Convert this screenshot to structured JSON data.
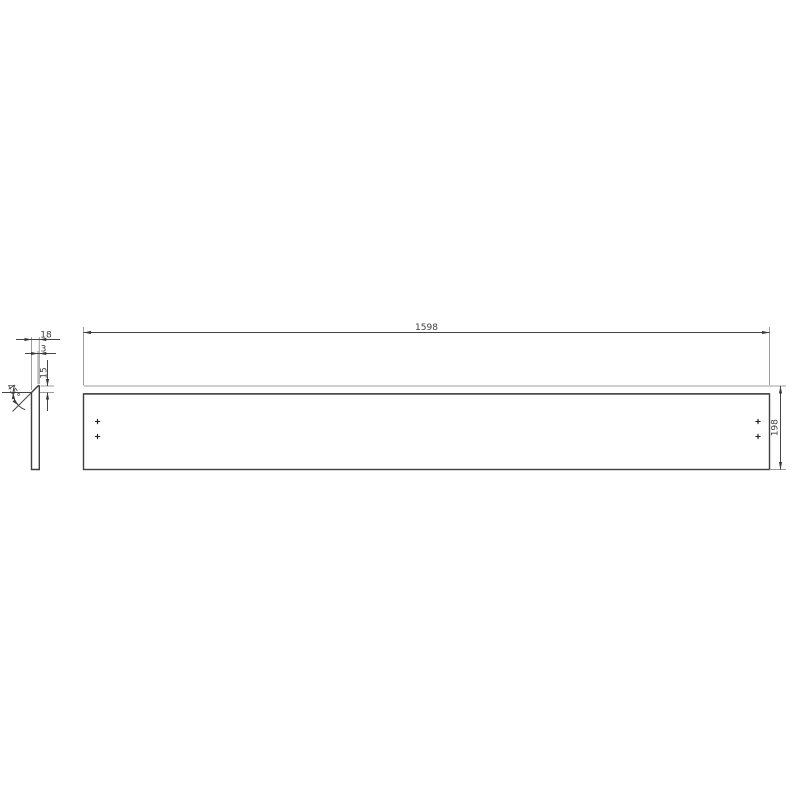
{
  "drawing": {
    "dimensions": {
      "length": "1598",
      "height": "198",
      "thickness": "18",
      "edge_thickness": "3",
      "bevel_height": "15",
      "bevel_angle": "45°"
    },
    "colors": {
      "outline": "#404040",
      "dimension_line": "#444444",
      "extension_line": "#9c9c9c",
      "text": "#3d3d3d",
      "background": "#ffffff"
    },
    "hole_marks_count": 4
  }
}
